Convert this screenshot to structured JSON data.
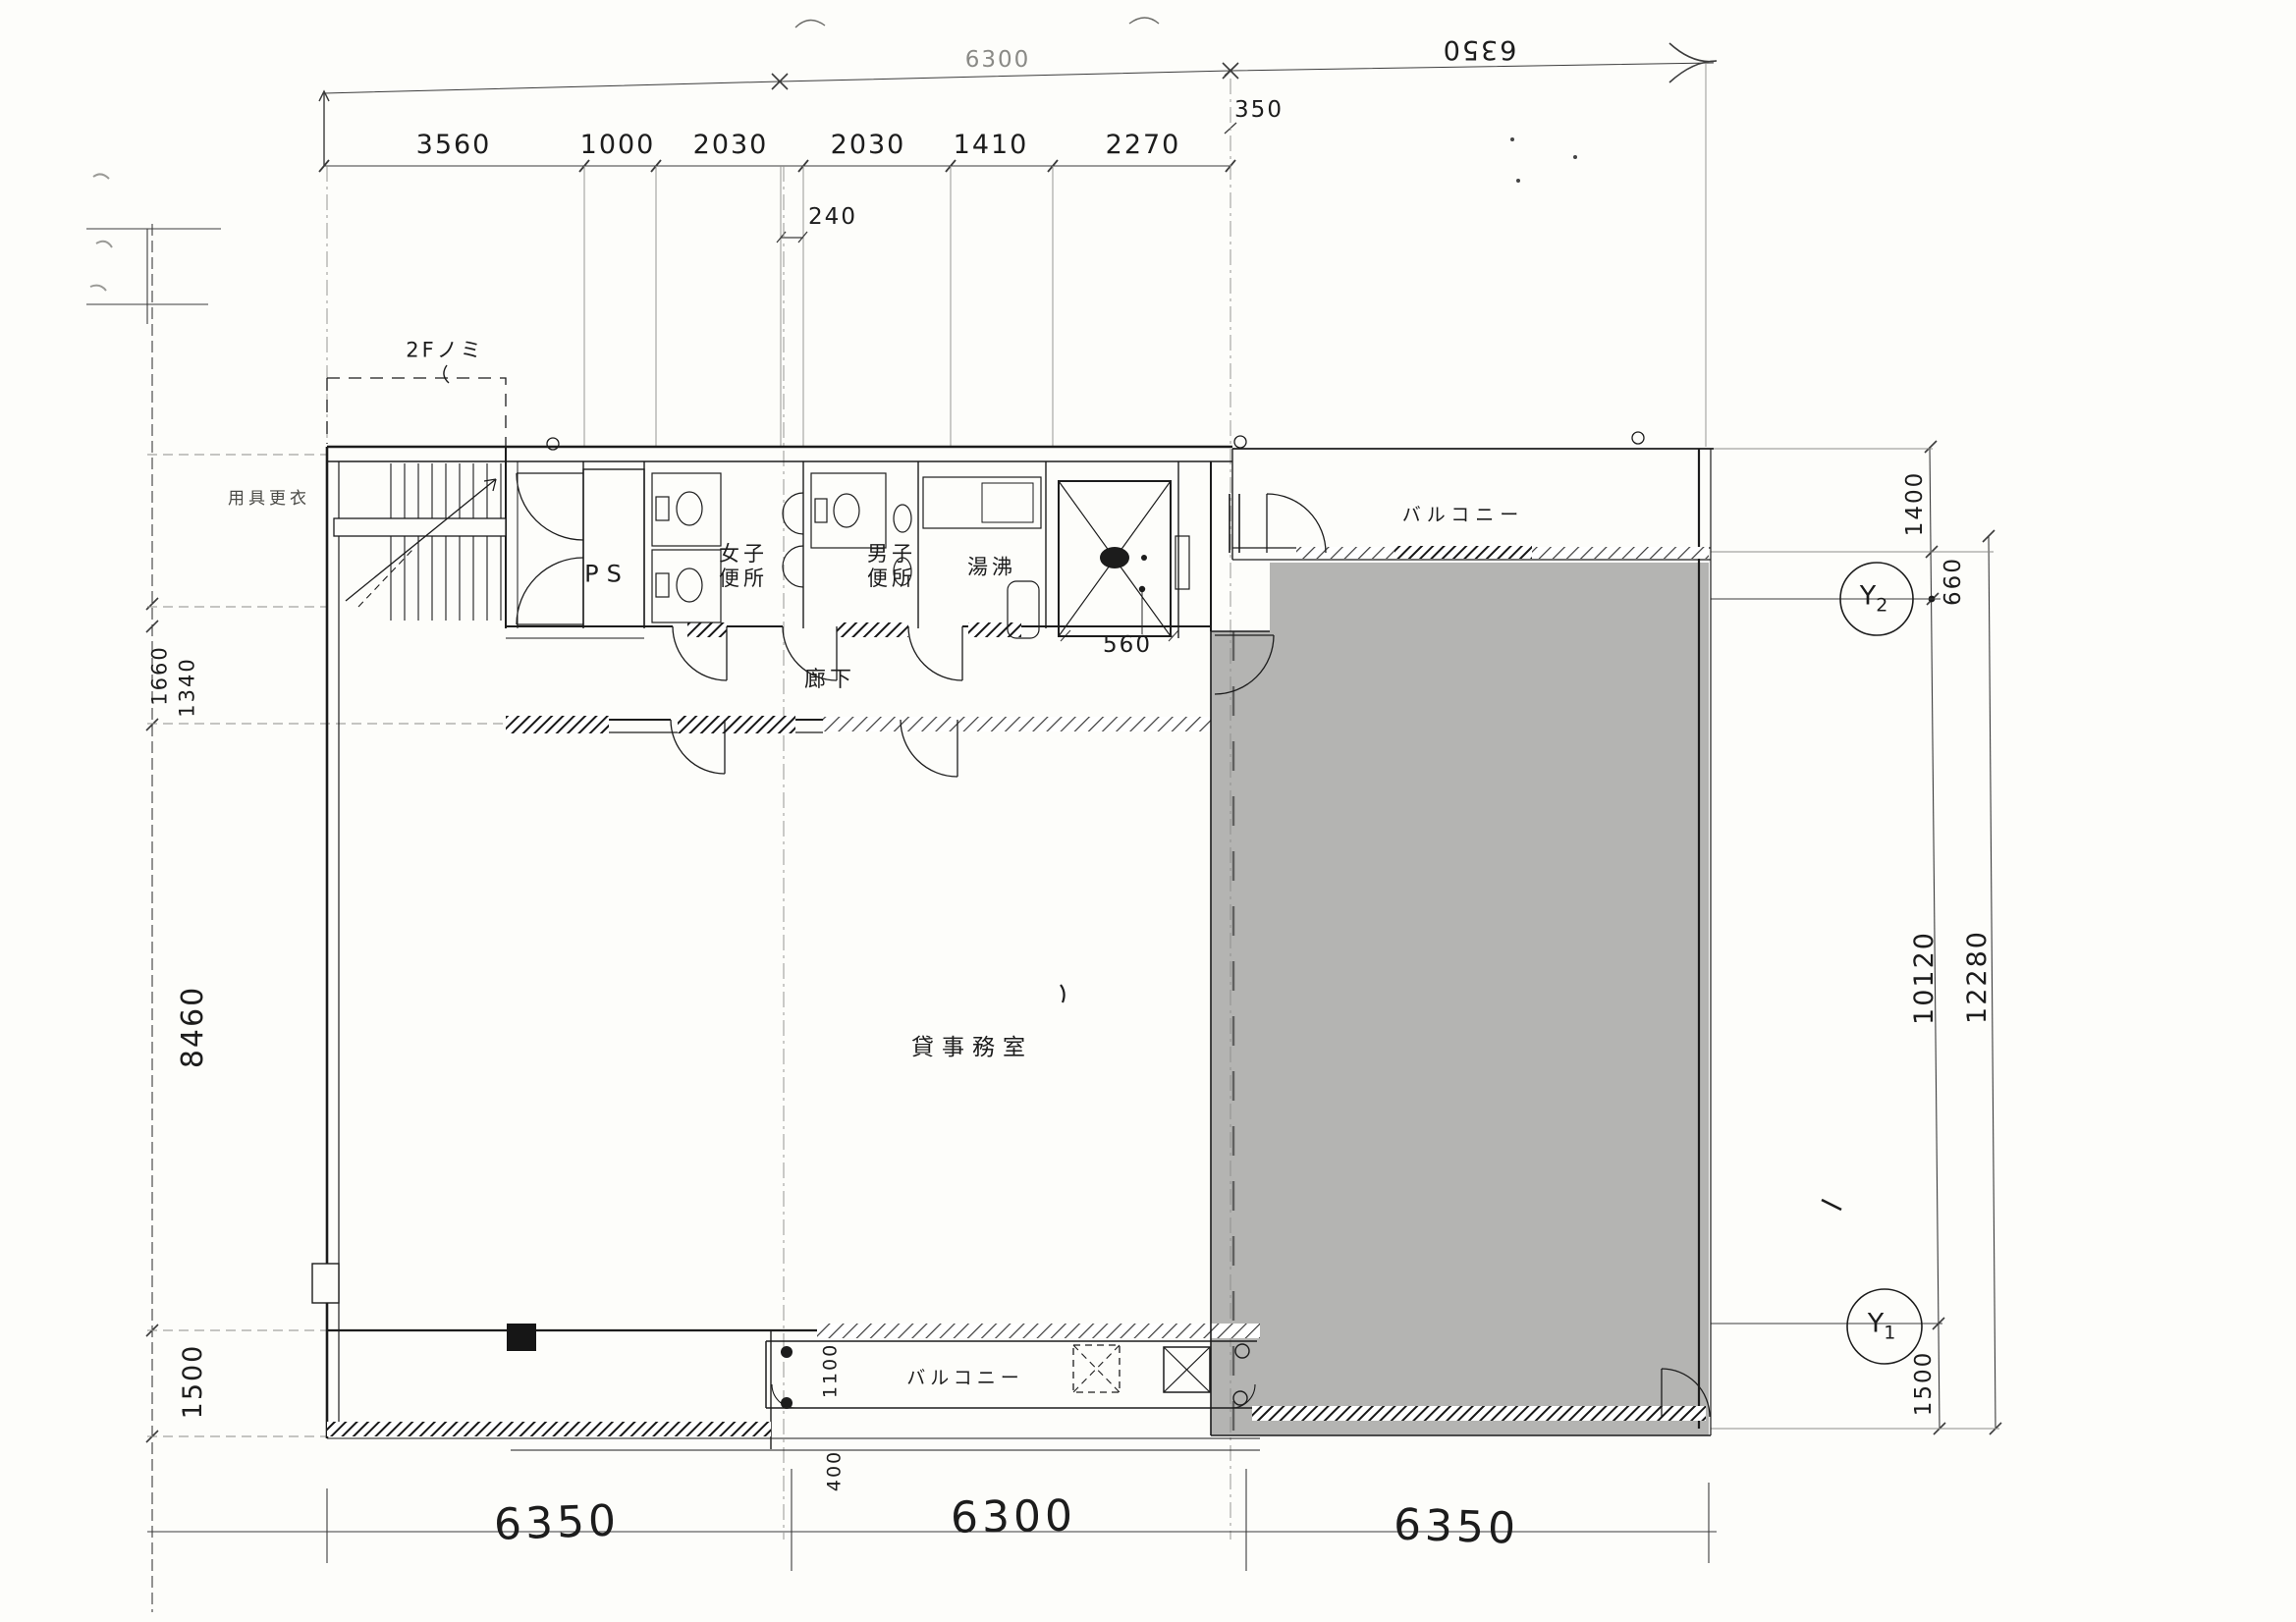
{
  "labels": {
    "floor_note": "2Fノミ",
    "storage": "用具更衣",
    "ps": "PS",
    "womens_toilet": "女子\n便所",
    "mens_toilet": "男子\n便所",
    "kitchenette": "湯沸",
    "corridor": "廊下",
    "office": "貸事務室",
    "balcony_top": "バルコニー",
    "balcony_bottom": "バルコニー"
  },
  "grid_bubbles": {
    "y2": {
      "label": "Y",
      "index": "2"
    },
    "y1": {
      "label": "Y",
      "index": "1"
    }
  },
  "dimensions": {
    "top_overall_left": "6300",
    "top_overall_right": "6350",
    "top_chain": [
      "3560",
      "1000",
      "2030",
      "2030",
      "1410",
      "2270"
    ],
    "top_sub_240": "240",
    "top_sub_350": "350",
    "core_sub_560": "560",
    "right": {
      "d1400": "1400",
      "d660": "660",
      "d10120": "10120",
      "d12280": "12280",
      "d1500": "1500"
    },
    "left": {
      "d1660": "1660",
      "d1340": "1340",
      "d8460": "8460",
      "d1500": "1500"
    },
    "bottom": [
      "6350",
      "6300",
      "6350"
    ],
    "balcony_sub": {
      "d1100": "1100",
      "d400": "400"
    }
  },
  "colors": {
    "shaded_region": "#b4b4b2",
    "ink": "#1c1c1c"
  }
}
